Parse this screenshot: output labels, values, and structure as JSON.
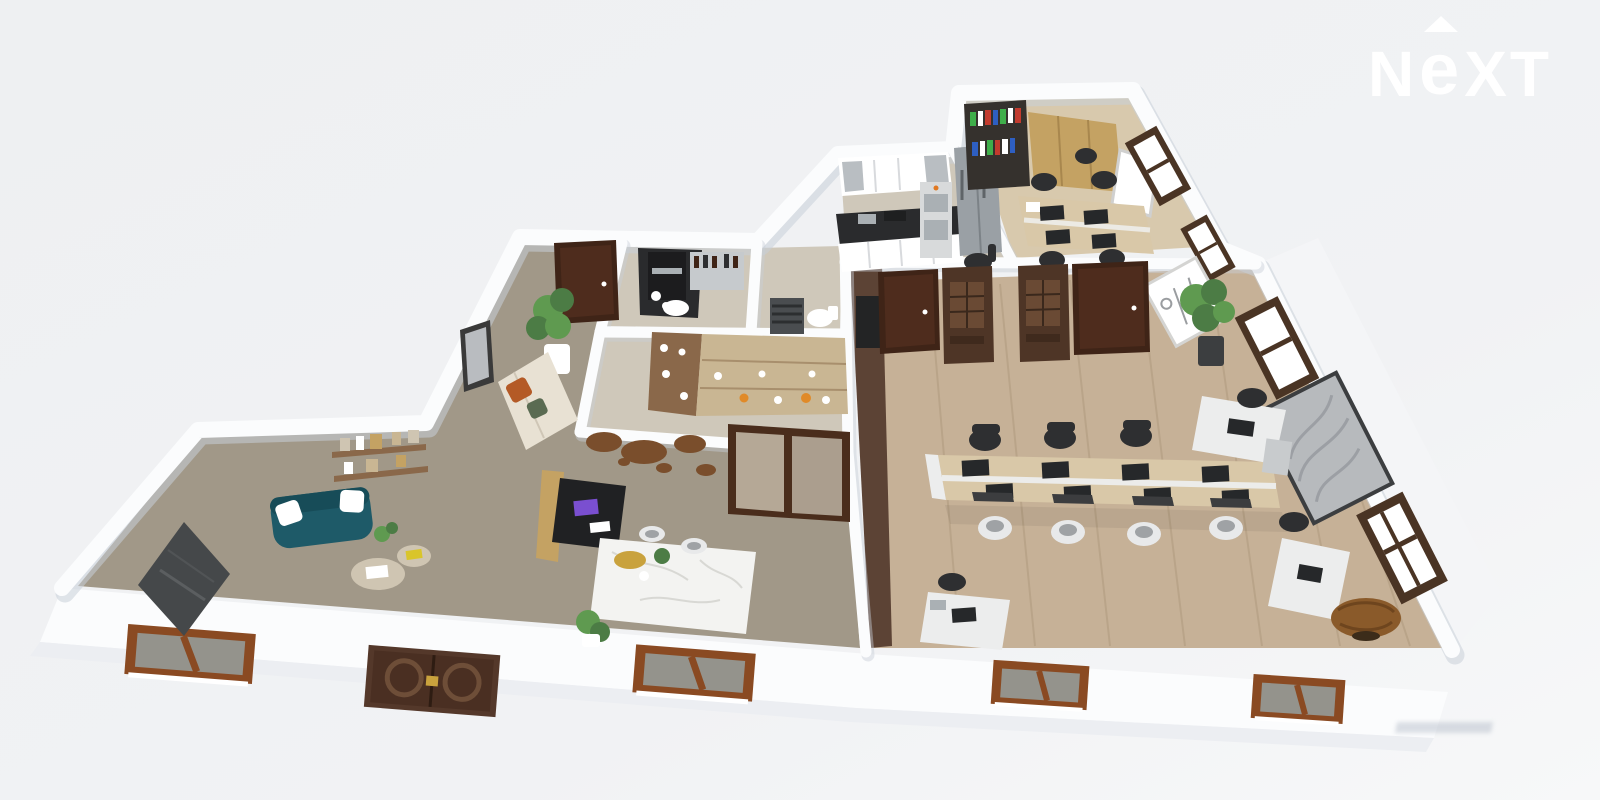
{
  "brand": {
    "name": "NEXT",
    "letters": [
      "N",
      "e",
      "X",
      "T"
    ],
    "arrow": "roof-caret-icon"
  },
  "colors": {
    "bg": "#f0f1f3",
    "bg_low": "#f7f8f9",
    "wall": "#fbfcfd",
    "wall_shadow": "#c8cfd8",
    "wall_face": "#eceef2",
    "carpet": "#a19888",
    "tile_kitchen": "#cfc8ba",
    "wood_office": "#d8c9ad",
    "wood_open": "#c6b197",
    "wood_streak": "#ab9579",
    "corridor": "#5c4335",
    "teal": "#1e5a68",
    "teal_dark": "#174c58",
    "cream": "#e8e1d3",
    "orange": "#b45a26",
    "green_dark": "#4c7c45",
    "green": "#5f9a50",
    "door": "#4e2c1d",
    "door_dark": "#3f2417",
    "antique": "#4e3526",
    "frame_orange": "#8a4a22",
    "glass_dark": "#94938c",
    "tan": "#c4a263",
    "shelf_wood": "#8a684a",
    "shelf_tan": "#c9b693",
    "counter": "#2a2b2d",
    "steel": "#aab0b4",
    "fridge": "#9aa0a5",
    "marble": "#f3f3f1",
    "vein": "#d8d8d4",
    "map": "#7a4e2c",
    "black": "#2e2f31",
    "chair_white": "#e8e9ea",
    "chair_gray": "#9fa2a5",
    "desk_wood": "#d9c8a8",
    "desk_white": "#eceded",
    "monitor": "#26282a",
    "mat": "#3c3d3f",
    "art": "#b7babd",
    "art_streak": "#90949a",
    "board": "#45484a",
    "white": "#ffffff",
    "gold": "#c9a23d",
    "globe": "#8a5a2a",
    "pouf": "#cfc5b2",
    "book_green": "#3fae4a",
    "book_red": "#c23b2e",
    "book_blue": "#2e5fc2"
  },
  "scene": {
    "type": "3d-floorplan-dollhouse-render",
    "rooms": [
      {
        "name": "lounge",
        "floor": "gray-taupe carpet",
        "items": [
          "teal-sofa",
          "white-pillows",
          "wall-shelf-decor",
          "leaning-chalkboard",
          "round-poufs",
          "plant-sprig"
        ]
      },
      {
        "name": "entry-hall",
        "floor": "gray-taupe carpet",
        "items": [
          "entry-door",
          "potted-plant",
          "cream-sofa",
          "orange-pillow",
          "wall-picture"
        ]
      },
      {
        "name": "coffee-room",
        "items": [
          "coffee-counter",
          "coffee-machine",
          "wall-shelf-bottles",
          "sink"
        ]
      },
      {
        "name": "bathroom",
        "items": [
          "towel-radiator",
          "toilet"
        ]
      },
      {
        "name": "display-room",
        "items": [
          "display-shelf-unit",
          "world-map-wall-art",
          "sliding-glass-door"
        ]
      },
      {
        "name": "reception",
        "items": [
          "reception-desk",
          "marble-island",
          "wood-cabinet",
          "gold-tray",
          "guest-chairs",
          "potted-plant"
        ]
      },
      {
        "name": "kitchen",
        "items": [
          "white-cabinets",
          "black-countertop",
          "fridge",
          "double-oven",
          "bar-chair"
        ]
      },
      {
        "name": "private-office",
        "floor": "light wood",
        "items": [
          "bookshelf-colorful-books",
          "tan-cabinets",
          "flipchart-easel",
          "quad-desk",
          "office-chairs",
          "whiteboard",
          "windows"
        ]
      },
      {
        "name": "open-office",
        "floor": "wood plank",
        "items": [
          "bench-desk-8-seats",
          "monitors",
          "black-chairs",
          "white-chairs",
          "corner-desk",
          "entry-doors",
          "antique-display-cabinets",
          "potted-plant",
          "wall-art-panel",
          "windows",
          "globe",
          "single-desks"
        ]
      }
    ],
    "exterior": {
      "items": [
        "ornate-double-door",
        "orange-frame-windows"
      ]
    }
  }
}
